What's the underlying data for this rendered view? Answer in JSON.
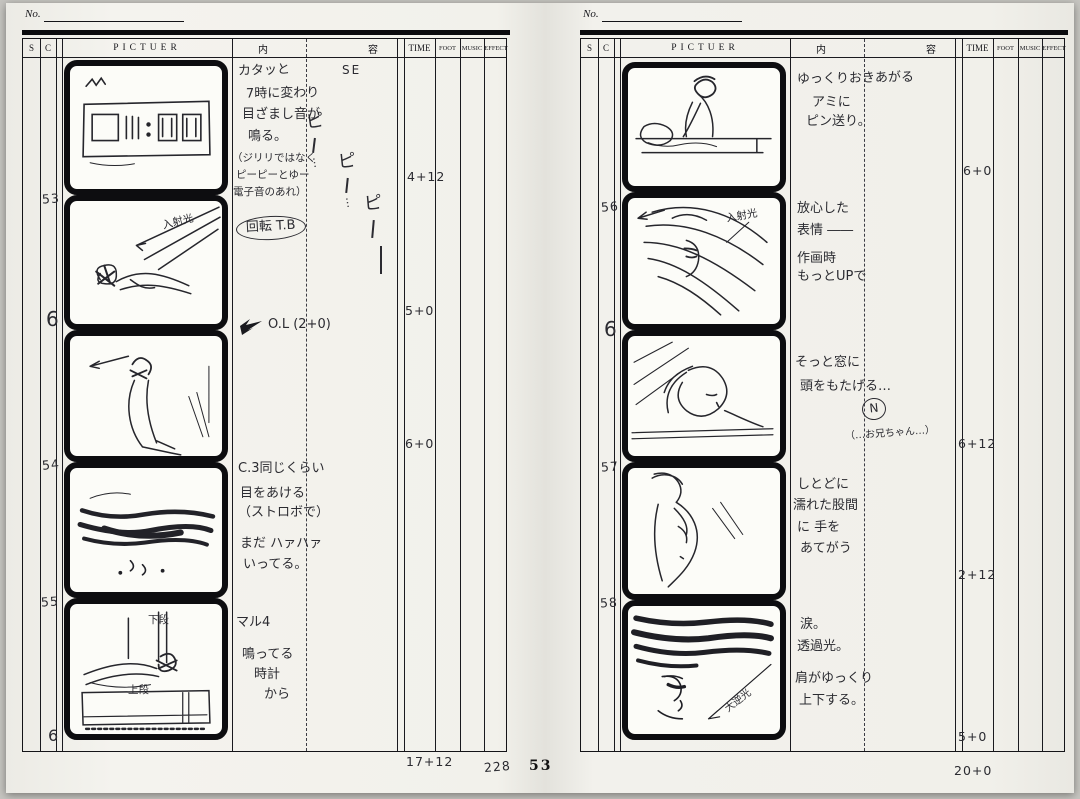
{
  "page": {
    "number": "53"
  },
  "columns": {
    "no_label": "No.",
    "s": "S",
    "c": "C",
    "picture": "PICTUER",
    "content_left": "内",
    "content_right": "容",
    "time": "TIME",
    "foot": "FOOT",
    "music": "MUSIC",
    "effect": "EFFECT"
  },
  "left": {
    "cuts": [
      "53",
      "6",
      "54",
      "55",
      "6"
    ],
    "panel_labels": {
      "p2_light": "入射光",
      "p5_top": "下段",
      "p5_bottom": "上段"
    },
    "notes": {
      "block1": [
        "カタッと",
        "7時に変わり",
        "目ざまし音が",
        "鳴る。",
        "（ジリリではなく",
        "ピーピーとゆー",
        "電子音のあれ）"
      ],
      "se_label": "SE",
      "se_beeps": [
        "ピ",
        "ピ",
        "ピ"
      ],
      "se_trail": "…",
      "block2": "回転 T.B",
      "block3": "O.L (2+0)",
      "block4": [
        "C.3同じくらい",
        "目をあける",
        "（ストロボで）",
        "まだ ハァハァ",
        "いってる。"
      ],
      "block5": [
        "マル4",
        "鳴ってる",
        "時計",
        "から"
      ]
    },
    "times": [
      "4+12",
      "5+0",
      "6+0"
    ],
    "total": "17+12",
    "tally": "228"
  },
  "right": {
    "cuts": [
      "56",
      "6",
      "57",
      "58"
    ],
    "panel_labels": {
      "p2_light": "入射光",
      "p5_light": "大逆光"
    },
    "notes": {
      "block1": [
        "ゆっくりおきあがる",
        "アミに",
        "ピン送り。"
      ],
      "block2": [
        "放心した",
        "表情 ――",
        "作画時",
        "もっとUPで"
      ],
      "block3": [
        "そっと窓に",
        "頭をもたげる…"
      ],
      "block3_n": "N",
      "block3_voice": "（…お兄ちゃん…）",
      "block4": [
        "しとどに",
        "濡れた股間",
        "に 手を",
        "あてがう"
      ],
      "block5": [
        "涙。",
        "透過光。",
        "肩がゆっくり",
        "上下する。"
      ]
    },
    "times": [
      "6+0",
      "6+12",
      "2+12",
      "5+0"
    ],
    "total": "20+0"
  }
}
